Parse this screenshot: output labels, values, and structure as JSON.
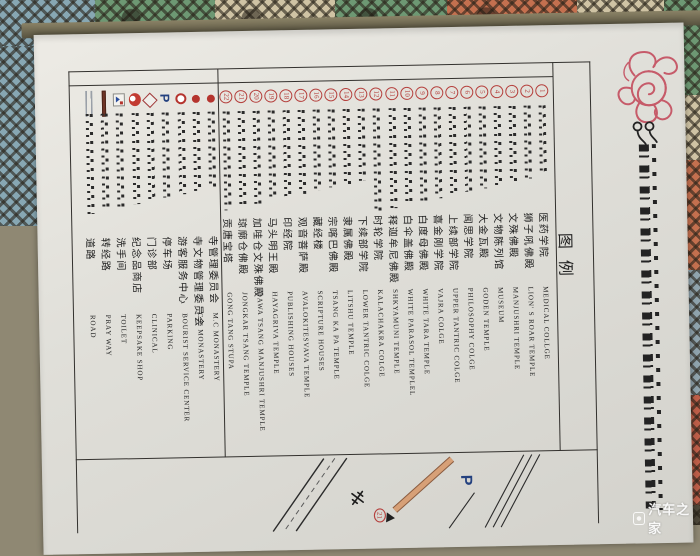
{
  "poster": {
    "legend_title": "图例",
    "tibetan_title_prefix": "༄༅།",
    "colors": {
      "badge_red": "#b5403d",
      "seal_red": "#c44d5e",
      "parking_blue": "#24417f",
      "map_road_orange": "#d7a077",
      "paper": "#e0dfd9"
    }
  },
  "legend": {
    "numbered_items": [
      {
        "num": "1",
        "zh": "医药学院",
        "en": "MEDICAL COLLGE"
      },
      {
        "num": "2",
        "zh": "狮子吼佛殿",
        "en": "LION' S ROAR TEMPLE"
      },
      {
        "num": "3",
        "zh": "文殊佛殿",
        "en": "MANJUSHRI TEMPLE"
      },
      {
        "num": "4",
        "zh": "文物陈列馆",
        "en": "MUSEUM"
      },
      {
        "num": "5",
        "zh": "大金瓦殿",
        "en": "GODEN TEMPLE"
      },
      {
        "num": "6",
        "zh": "闻思学院",
        "en": "PHILOSOPHY COLGE"
      },
      {
        "num": "7",
        "zh": "上续部学院",
        "en": "UPPER TANTRIC COLGE"
      },
      {
        "num": "8",
        "zh": "喜金刚学院",
        "en": "VAJRA COLGE"
      },
      {
        "num": "9",
        "zh": "白度母佛殿",
        "en": "WHITE TARA TEMPLE"
      },
      {
        "num": "10",
        "zh": "白伞盖佛殿",
        "en": "WHITE PARASOL TEMPLEL"
      },
      {
        "num": "11",
        "zh": "释迦牟尼佛殿",
        "en": "SHKYAMUNI TEMPLE"
      },
      {
        "num": "12",
        "zh": "时轮学院",
        "en": "KALACHAKRA COLGE"
      },
      {
        "num": "13",
        "zh": "下续部学院",
        "en": "LOWER TANTRIC COLGE"
      },
      {
        "num": "14",
        "zh": "隶属佛殿",
        "en": "LITSHU TEMPLE"
      },
      {
        "num": "15",
        "zh": "宗喀巴佛殿",
        "en": "TSANG KA PA TEMPLE"
      },
      {
        "num": "16",
        "zh": "藏经楼",
        "en": "SCRIPTURE HOUSES"
      },
      {
        "num": "17",
        "zh": "观音菩萨殿",
        "en": "AVALOKITESVAVA TEMPLE"
      },
      {
        "num": "18",
        "zh": "印经院",
        "en": "PUBLISHING HOUSES"
      },
      {
        "num": "19",
        "zh": "马头明王殿",
        "en": "HAYAGRIVA TEMPLE"
      },
      {
        "num": "20",
        "zh": "加哇仓文殊佛殿",
        "en": "DAWA TSANG MANJUSHRI TEMPLE"
      },
      {
        "num": "21",
        "zh": "琼廓仓佛殿",
        "en": "JONGKAR TSANG TEMPLE"
      },
      {
        "num": "22",
        "zh": "贡唐宝塔",
        "en": "GONG TANG STUPA"
      }
    ],
    "symbol_items": [
      {
        "icon": "red-dot",
        "zh": "寺管理委员会",
        "en": "M.C MONASTERY"
      },
      {
        "icon": "red-dot",
        "zh": "寺文物管理委员会",
        "en": "C.C MONASTERY"
      },
      {
        "icon": "red-ring",
        "zh": "游客服务中心",
        "en": "BOURIST SERVICE CENTER"
      },
      {
        "icon": "blue-p",
        "zh": "停车场",
        "en": "PARKING",
        "icon_label": "P"
      },
      {
        "icon": "diamond",
        "zh": "门诊部",
        "en": "CLINICAL"
      },
      {
        "icon": "red-ball",
        "zh": "纪念品商店",
        "en": "KEEPSAKE SHOP"
      },
      {
        "icon": "toilet-sign",
        "zh": "洗手间",
        "en": "TOILET"
      },
      {
        "icon": "maroon-bar",
        "zh": "转经路",
        "en": "PRAY WAY"
      },
      {
        "icon": "double-line",
        "zh": "道路",
        "en": "ROAD"
      }
    ]
  },
  "map_preview": {
    "parking_label": "P",
    "circled_number": "21"
  },
  "watermark": {
    "text": "汽车之家"
  }
}
